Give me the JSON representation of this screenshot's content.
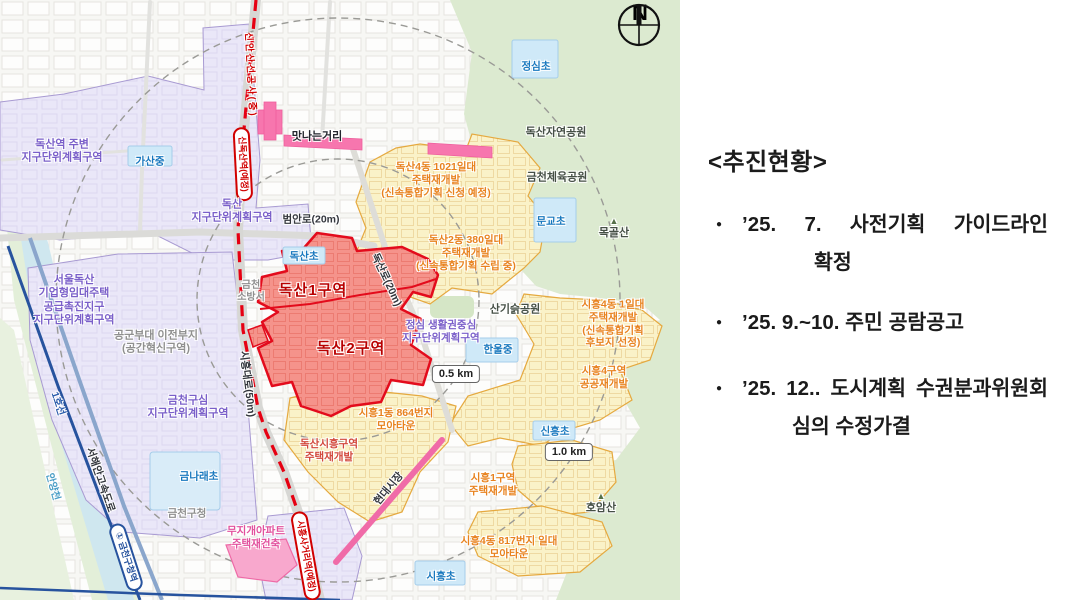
{
  "panel": {
    "heading": "<추진현황>",
    "bullet": "●",
    "items": [
      {
        "l1": "’25. 7. 사전기획 가이드라인",
        "l2": "확정"
      },
      {
        "l1": "’25. 9.~10. 주민 공람공고",
        "l2": ""
      },
      {
        "l1": "’25. 12.. 도시계획 수권분과위원회",
        "l2": "심의 수정가결"
      }
    ]
  },
  "map": {
    "compass_n": "N",
    "scale_05": "0.5 km",
    "scale_10": "1.0 km",
    "stations": {
      "sindoksan": "신독산역(예정)",
      "siheung_sageori": "시흥사거리역(예정)",
      "geumcheon_guchung": "① 금천구청역"
    },
    "lines": {
      "sinansan": "신안산선공사(중)",
      "line1": "1호선",
      "seohaean_expwy": "서해안고속도로",
      "anyangcheon": "안양천",
      "siheung_daero": "시흥대로(50m)",
      "beoman_ro": "범안로(20m)",
      "doksan_ro": "독산로(20m)",
      "hyundai_market": "현대시장"
    },
    "zones": {
      "doksan_station_udp": "독산역 주변\n지구단위계획구역",
      "doksan_udp": "독산\n지구단위계획구역",
      "seoul_doksan": "서울독산\n기업형임대주택\n공급촉진지구\n지구단위계획구역",
      "gonggun": "공군부대 이전부지\n(공간혁신구역)",
      "geumcheon_gusim": "금천구심\n지구단위계획구역",
      "jeongsim_udp": "정심 생활권중심\n지구단위계획구역",
      "doksan1": "독산1구역",
      "doksan2": "독산2구역",
      "doksan4dong": "독산4동 1021일대\n주택재개발\n(신속통합기획 신청 예정)",
      "doksan2dong": "독산2동 380일대\n주택재개발\n(신속통합기획 수립 중)",
      "siheung4dong": "시흥4동 1일대\n주택재개발\n(신속통합기획 후보지 선정)",
      "siheung4guyeok": "시흥4구역\n공공재개발",
      "siheung1dong864": "시흥1동 864번지\n모아타운",
      "doksan_siheung": "독산시흥구역\n주택재개발",
      "siheung1guyeok": "시흥1구역\n주택재개발",
      "siheung4dong817": "시흥4동 817번지 일대\n모아타운",
      "mujigae": "무지개아파트\n주택재건축",
      "matna": "맛나는거리"
    },
    "places": {
      "gasan_middle": "가산중",
      "doksan_elem": "독산초",
      "geumcheon_fire": "금천\n소방서",
      "geumnarae_elem": "금나래초",
      "geumcheon_office": "금천구청",
      "jeongsim_elem": "정심초",
      "mungyo_elem": "문교초",
      "hanul_middle": "한울중",
      "sinheung_elem": "신흥초",
      "siheung_elem": "시흥초",
      "doksan_nature_park": "독산자연공원",
      "geumcheon_sports_park": "금천체육공원",
      "sangi_park": "산기슭공원",
      "mokgol_san": "목골산",
      "hoam_san": "호암산",
      "mountain_marker": "▲"
    },
    "colors": {
      "red_zone_fill": "#f5938b",
      "red_zone_border": "#e30b1c",
      "yellow_zone_fill": "#faf2c8",
      "yellow_zone_border": "#e5a93f",
      "purple_zone_fill": "#eae7f8",
      "park_green": "#dcead0",
      "planned_subway_red": "#e60012",
      "rail_blue": "#27539e",
      "pink_street": "#f776ae"
    }
  }
}
